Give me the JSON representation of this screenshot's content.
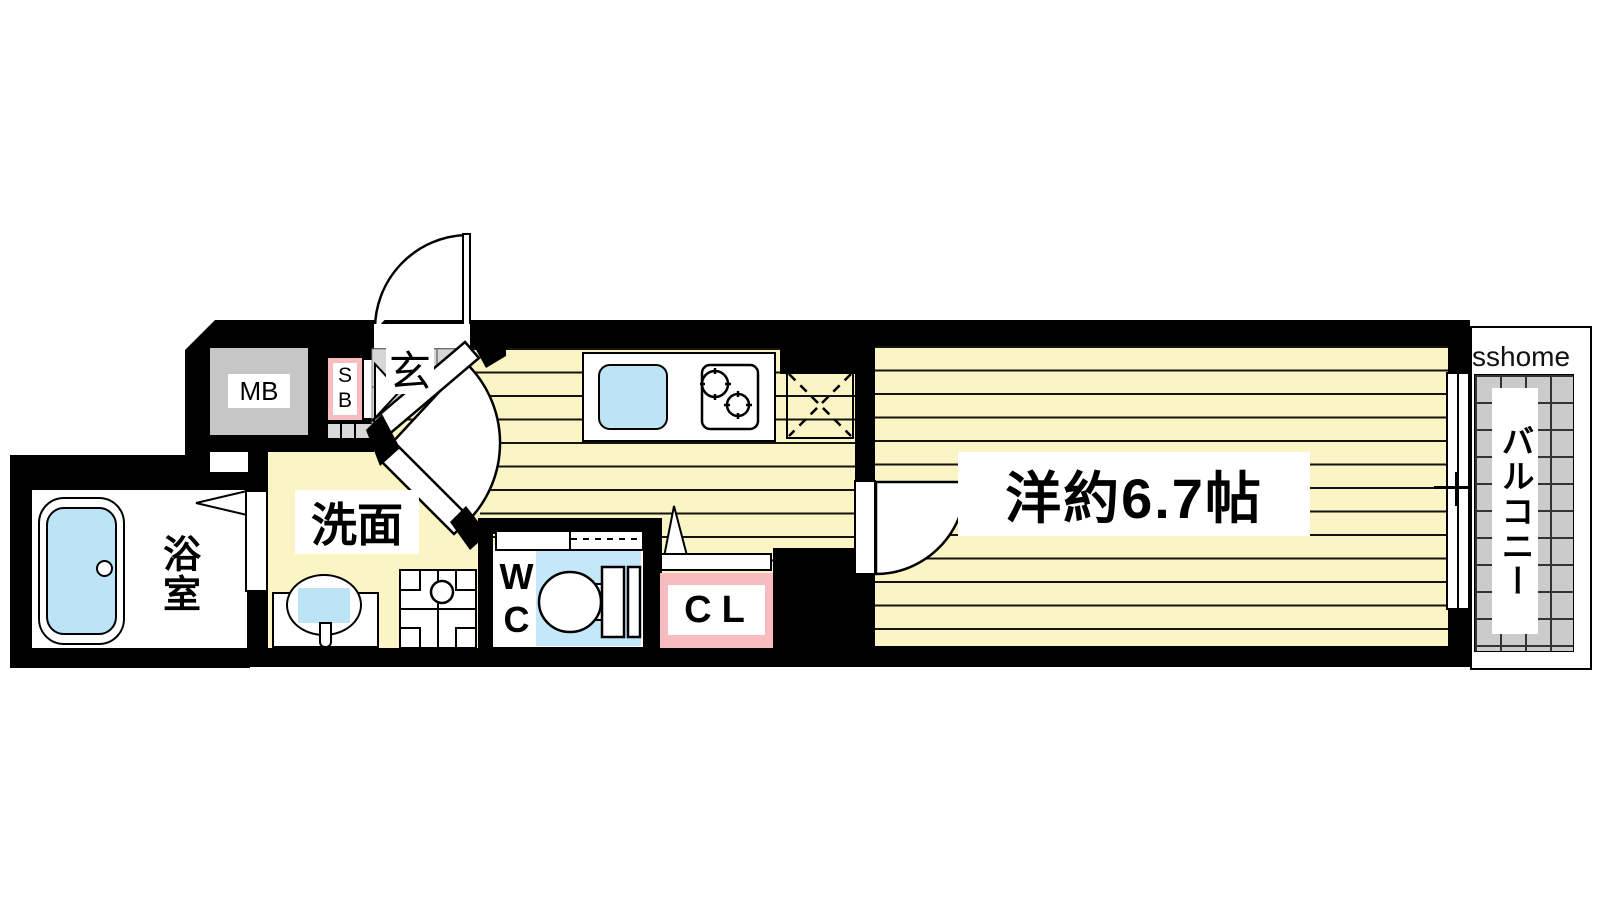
{
  "plan_title": "1K apartment floor plan",
  "watermark": "sshome",
  "rooms": {
    "main": {
      "label": "洋約6.7帖"
    },
    "entrance": {
      "label": "玄"
    },
    "washroom": {
      "label": "洗面"
    },
    "bathroom": {
      "label": "浴室"
    },
    "wc": {
      "label": "WC"
    },
    "closet": {
      "label": "CL"
    },
    "shoebox": {
      "label": "SB"
    },
    "meterbox": {
      "label": "MB"
    },
    "balcony": {
      "label": "バルコニー"
    }
  },
  "colors": {
    "wall": "#000000",
    "floor_yellow": "#fbf5c5",
    "stripe": "#141414",
    "tile_gray": "#d6d6d6",
    "meterbox_gray": "#c6c6c6",
    "balcony_gray": "#cbcbcb",
    "pink": "#f8bcc0",
    "water_blue": "#bde3f6",
    "wc_floor_blue": "#c5e7fa"
  }
}
